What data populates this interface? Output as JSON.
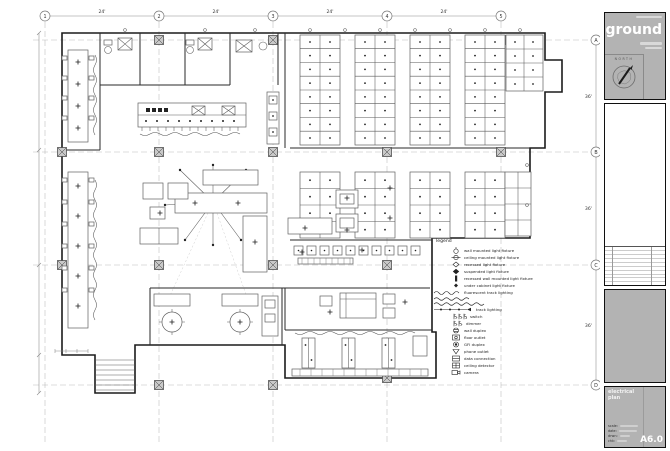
{
  "drawing": {
    "grid": {
      "top_bubbles": [
        "1",
        "2",
        "3",
        "4",
        "5"
      ],
      "top_dims": [
        "24'",
        "24'",
        "24'",
        "24'"
      ],
      "right_bubbles": [
        "A",
        "B",
        "C",
        "D"
      ],
      "right_dims": [
        "36'",
        "36'",
        "36'"
      ]
    },
    "legend": {
      "title": "legend",
      "items": [
        {
          "symbol": "wall-mounted-fixture-icon",
          "label": "wall mounted light fixture"
        },
        {
          "symbol": "ceiling-mounted-fixture-icon",
          "label": "ceiling mounted light fixture"
        },
        {
          "symbol": "recessed-fixture-icon",
          "label": "recessed light fixture"
        },
        {
          "symbol": "suspended-fixture-icon",
          "label": "suspended light fixture"
        },
        {
          "symbol": "recessed-wall-fixture-icon",
          "label": "recessed wall mounted light fixture"
        },
        {
          "symbol": "under-cabinet-fixture-icon",
          "label": "under cabinet light fixture"
        },
        {
          "symbol": "fluorescent-track-icon",
          "label": "fluorescent track lighting"
        },
        {
          "symbol": "track-lighting-icon",
          "label": "track lighting"
        },
        {
          "symbol": "switch-icon",
          "label": "switch"
        },
        {
          "symbol": "dimmer-icon",
          "label": "dimmer"
        },
        {
          "symbol": "wall-duplex-icon",
          "label": "wall duplex"
        },
        {
          "symbol": "floor-outlet-icon",
          "label": "floor outlet"
        },
        {
          "symbol": "gfi-duplex-icon",
          "label": "GFI duplex"
        },
        {
          "symbol": "phone-outlet-icon",
          "label": "phone outlet"
        },
        {
          "symbol": "data-connection-icon",
          "label": "data connection"
        },
        {
          "symbol": "ceiling-detector-icon",
          "label": "ceiling detector"
        },
        {
          "symbol": "camera-icon",
          "label": "camera"
        }
      ]
    }
  },
  "titleblock": {
    "floor_label": "ground",
    "north_label": "NORTH",
    "sheet_title": "electrical plan",
    "info_labels": {
      "scale": "scale:",
      "date": "date:",
      "drawn": "drwn:",
      "check": "chk:"
    },
    "sheet_number": "A6.0",
    "colors": {
      "panel_gray": "#b3b3b3",
      "line_black": "#101010"
    }
  }
}
